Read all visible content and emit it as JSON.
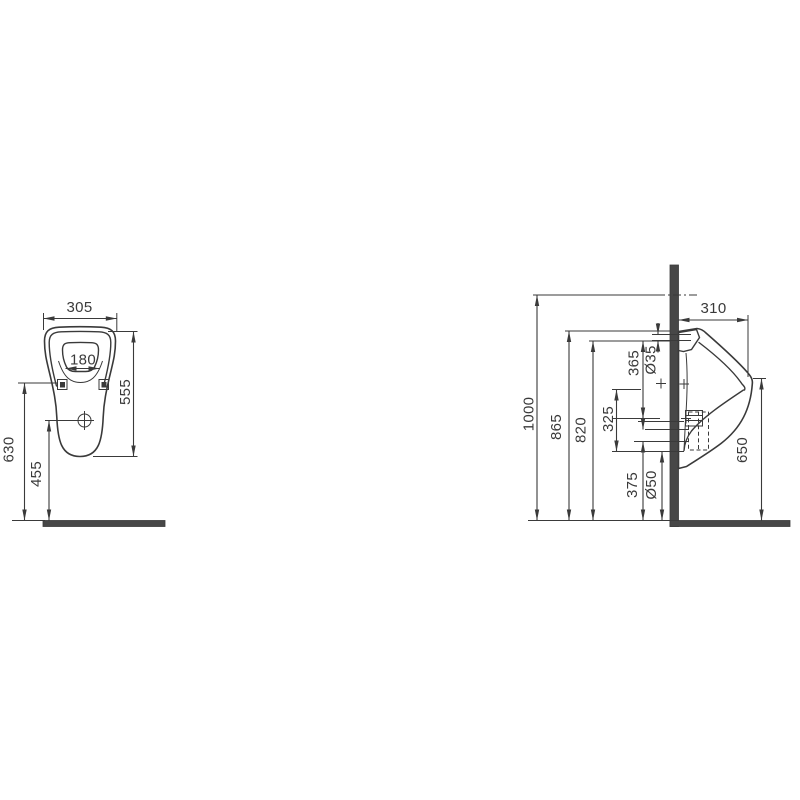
{
  "drawing": {
    "type": "technical-dimension-drawing",
    "subject": "wall-hung urinal, front and side elevation",
    "units": "mm",
    "colors": {
      "line": "#3a3a3a",
      "wall_fill": "#474747",
      "background": "#ffffff"
    },
    "front_view": {
      "dims": {
        "width": "305",
        "inner_width": "180",
        "height": "555",
        "fixing_height": "630",
        "outlet_height": "455"
      }
    },
    "side_view": {
      "dims": {
        "ref_height": "1000",
        "top_height": "865",
        "rim_height": "820",
        "inlet_drop": "365",
        "inlet_dia": "Ø35",
        "mid_span": "325",
        "outlet_drop": "375",
        "outlet_dia": "Ø50",
        "depth": "310",
        "lip_height": "650"
      }
    }
  }
}
